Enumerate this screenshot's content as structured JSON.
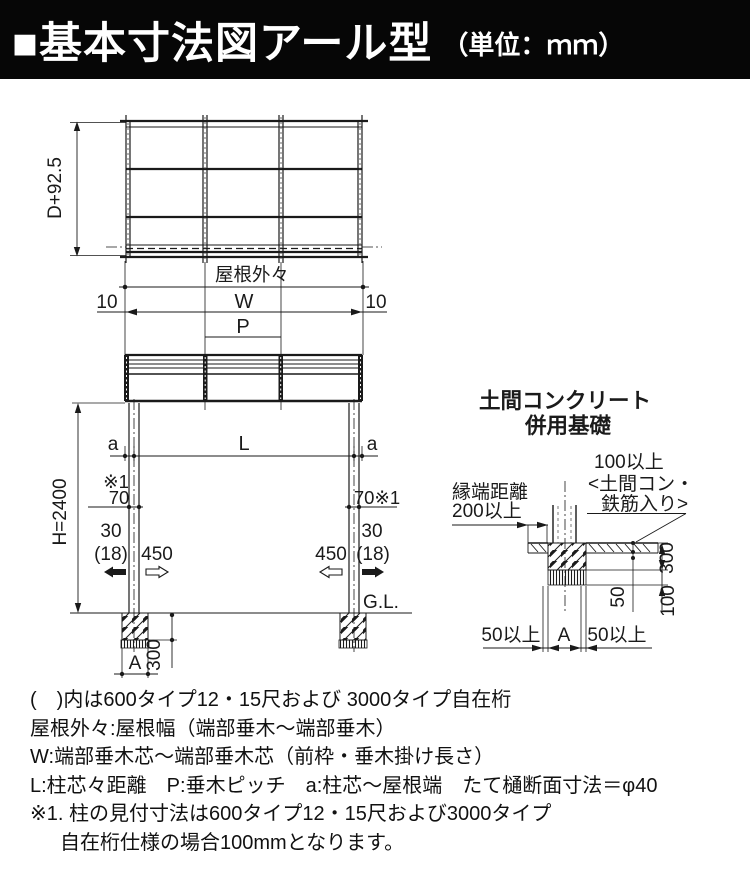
{
  "header": {
    "title": "■基本寸法図アール型",
    "unit": "（単位：ｍｍ）"
  },
  "plan_view": {
    "depth_dim": "D+92.5",
    "width_label": "屋根外々"
  },
  "elevation": {
    "offset_left": "10",
    "width": "W",
    "offset_right": "10",
    "pitch": "P",
    "a_left": "a",
    "span": "L",
    "a_right": "a",
    "note_ref": "※1",
    "post_width_left": "70",
    "post_width_right": "70※1",
    "clear_left_1": "30",
    "clear_left_2": "(18)",
    "embed_left": "450",
    "embed_right": "450",
    "clear_right_1": "30",
    "clear_right_2": "(18)",
    "height": "H=2400",
    "ground": "G.L.",
    "footing_depth": "300",
    "footing_width": "A"
  },
  "foundation_detail": {
    "title_line1": "土間コンクリート",
    "title_line2": "併用基礎",
    "edge_distance_line1": "縁端距離",
    "edge_distance_line2": "200以上",
    "slab_note_line1": "100以上",
    "slab_note_line2": "<土間コン・",
    "slab_note_line3": "鉄筋入り>",
    "dim_50": "50",
    "dim_300": "300",
    "dim_100": "100",
    "min_left": "50以上",
    "dim_a": "A",
    "min_right": "50以上"
  },
  "notes": {
    "line1": "(　)内は600タイプ12・15尺および 3000タイプ自在桁",
    "line2": "屋根外々:屋根幅（端部垂木～端部垂木）",
    "line3": "W:端部垂木芯～端部垂木芯（前枠・垂木掛け長さ）",
    "line4": "L:柱芯々距離　P:垂木ピッチ　a:柱芯～屋根端　たて樋断面寸法＝φ40",
    "line5": "※1. 柱の見付寸法は600タイプ12・15尺および3000タイプ",
    "line6": "自在桁仕様の場合100mmとなります。"
  },
  "colors": {
    "ink": "#1a1a1a",
    "banner": "#060606",
    "paper": "#ffffff"
  }
}
